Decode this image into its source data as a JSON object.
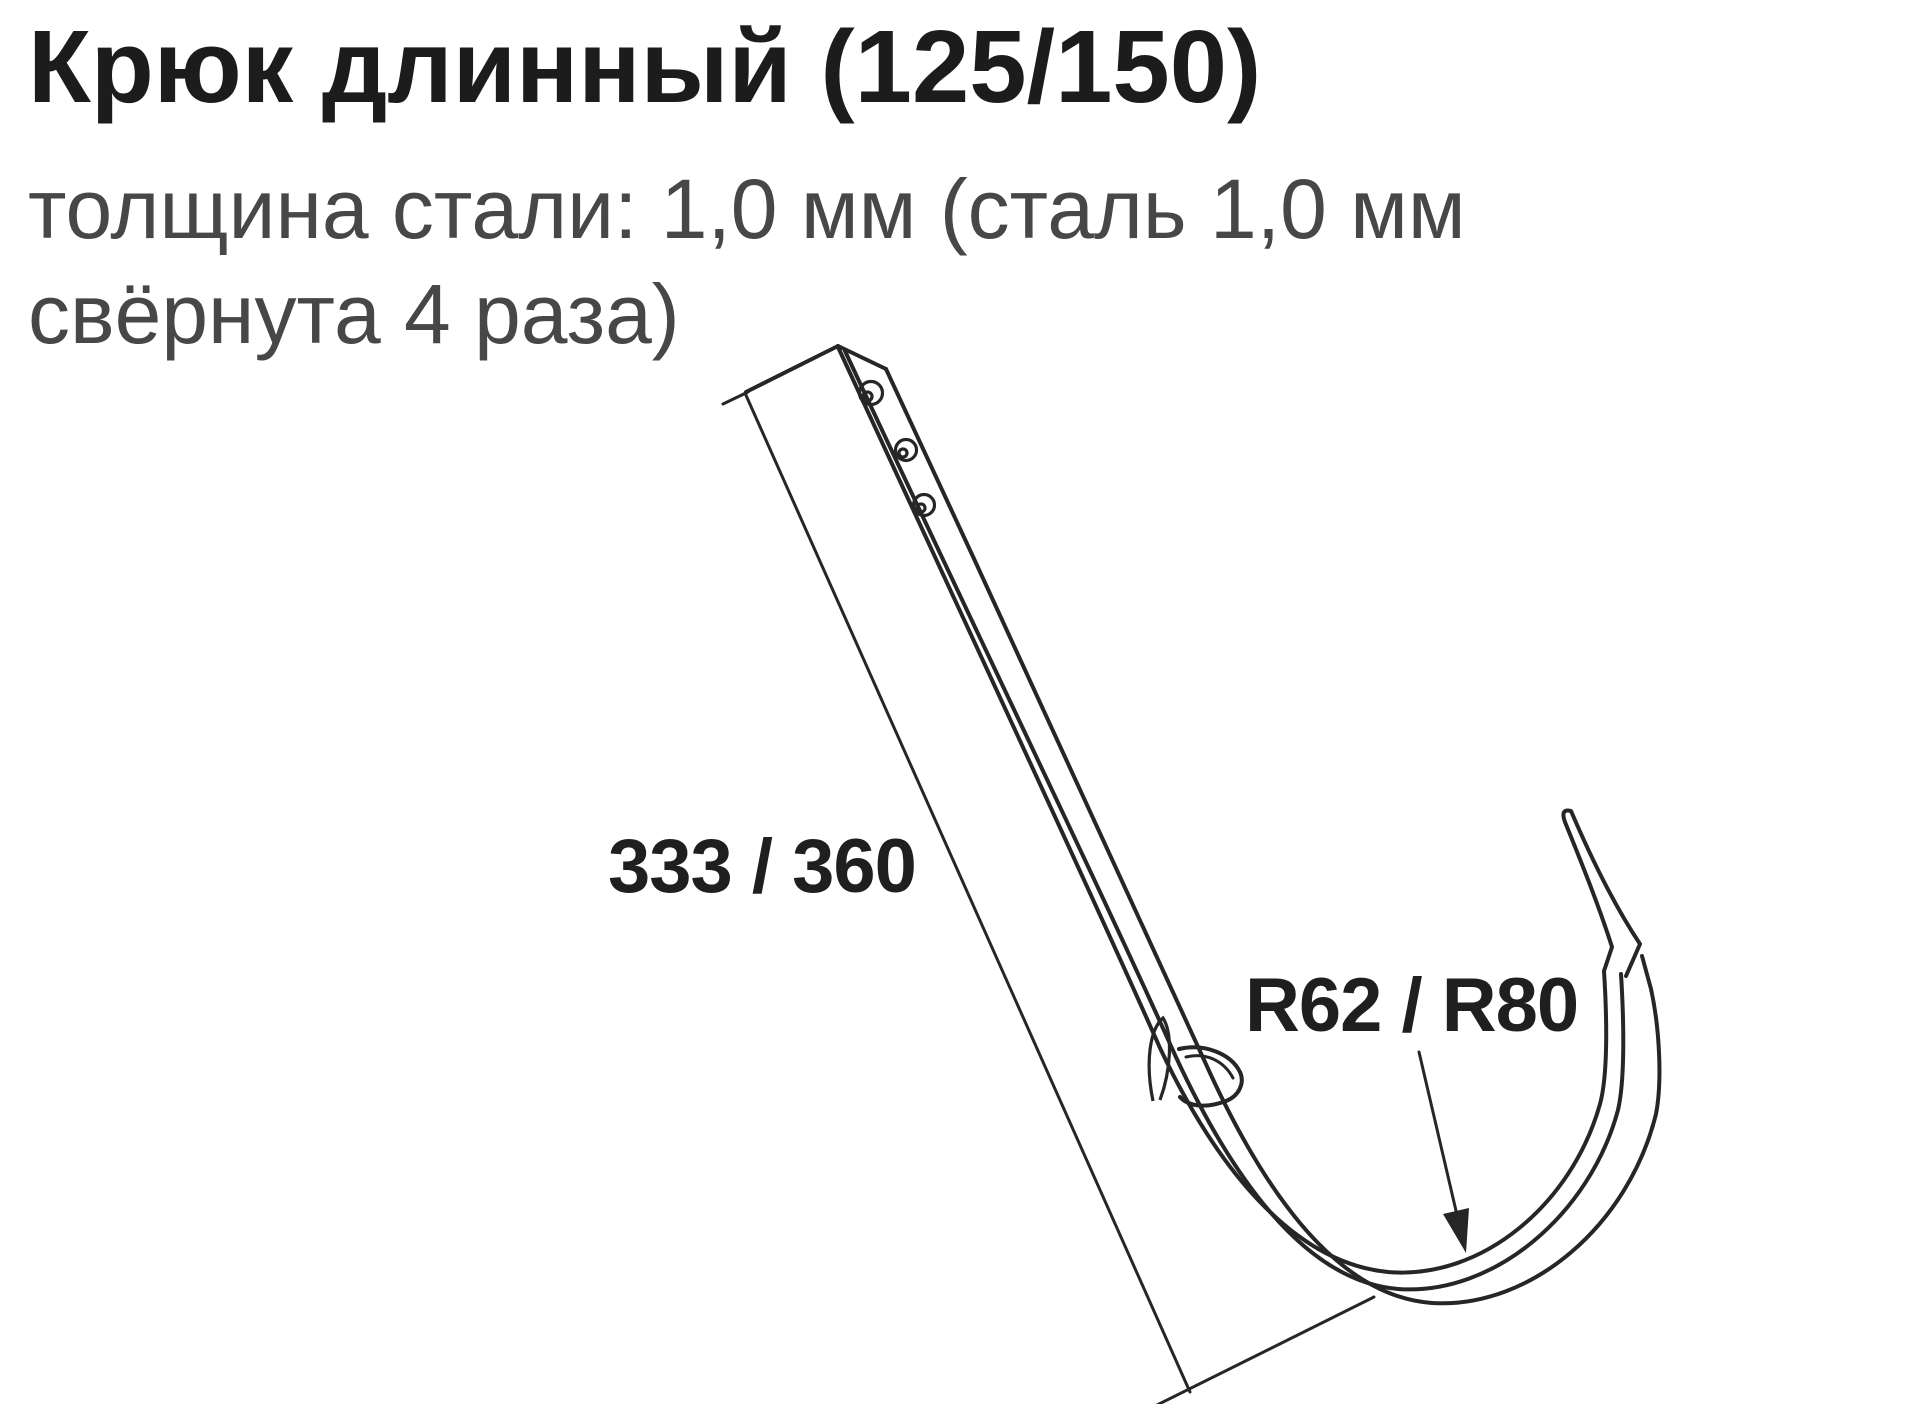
{
  "header": {
    "title": "Крюк длинный (125/150)",
    "subtitle_line1": "толщина стали: 1,0 мм (сталь 1,0 мм",
    "subtitle_line2": "свёрнута 4 раза)"
  },
  "diagram": {
    "type": "technical-line-drawing",
    "part": "long gutter hook bracket",
    "length_label": "333 / 360",
    "radius_label": "R62 / R80",
    "screw_hole_count": 3,
    "colors": {
      "background": "#ffffff",
      "title_text": "#1c1c1c",
      "subtitle_text": "#474747",
      "label_text": "#1f1f1f",
      "line": "#262626"
    }
  }
}
